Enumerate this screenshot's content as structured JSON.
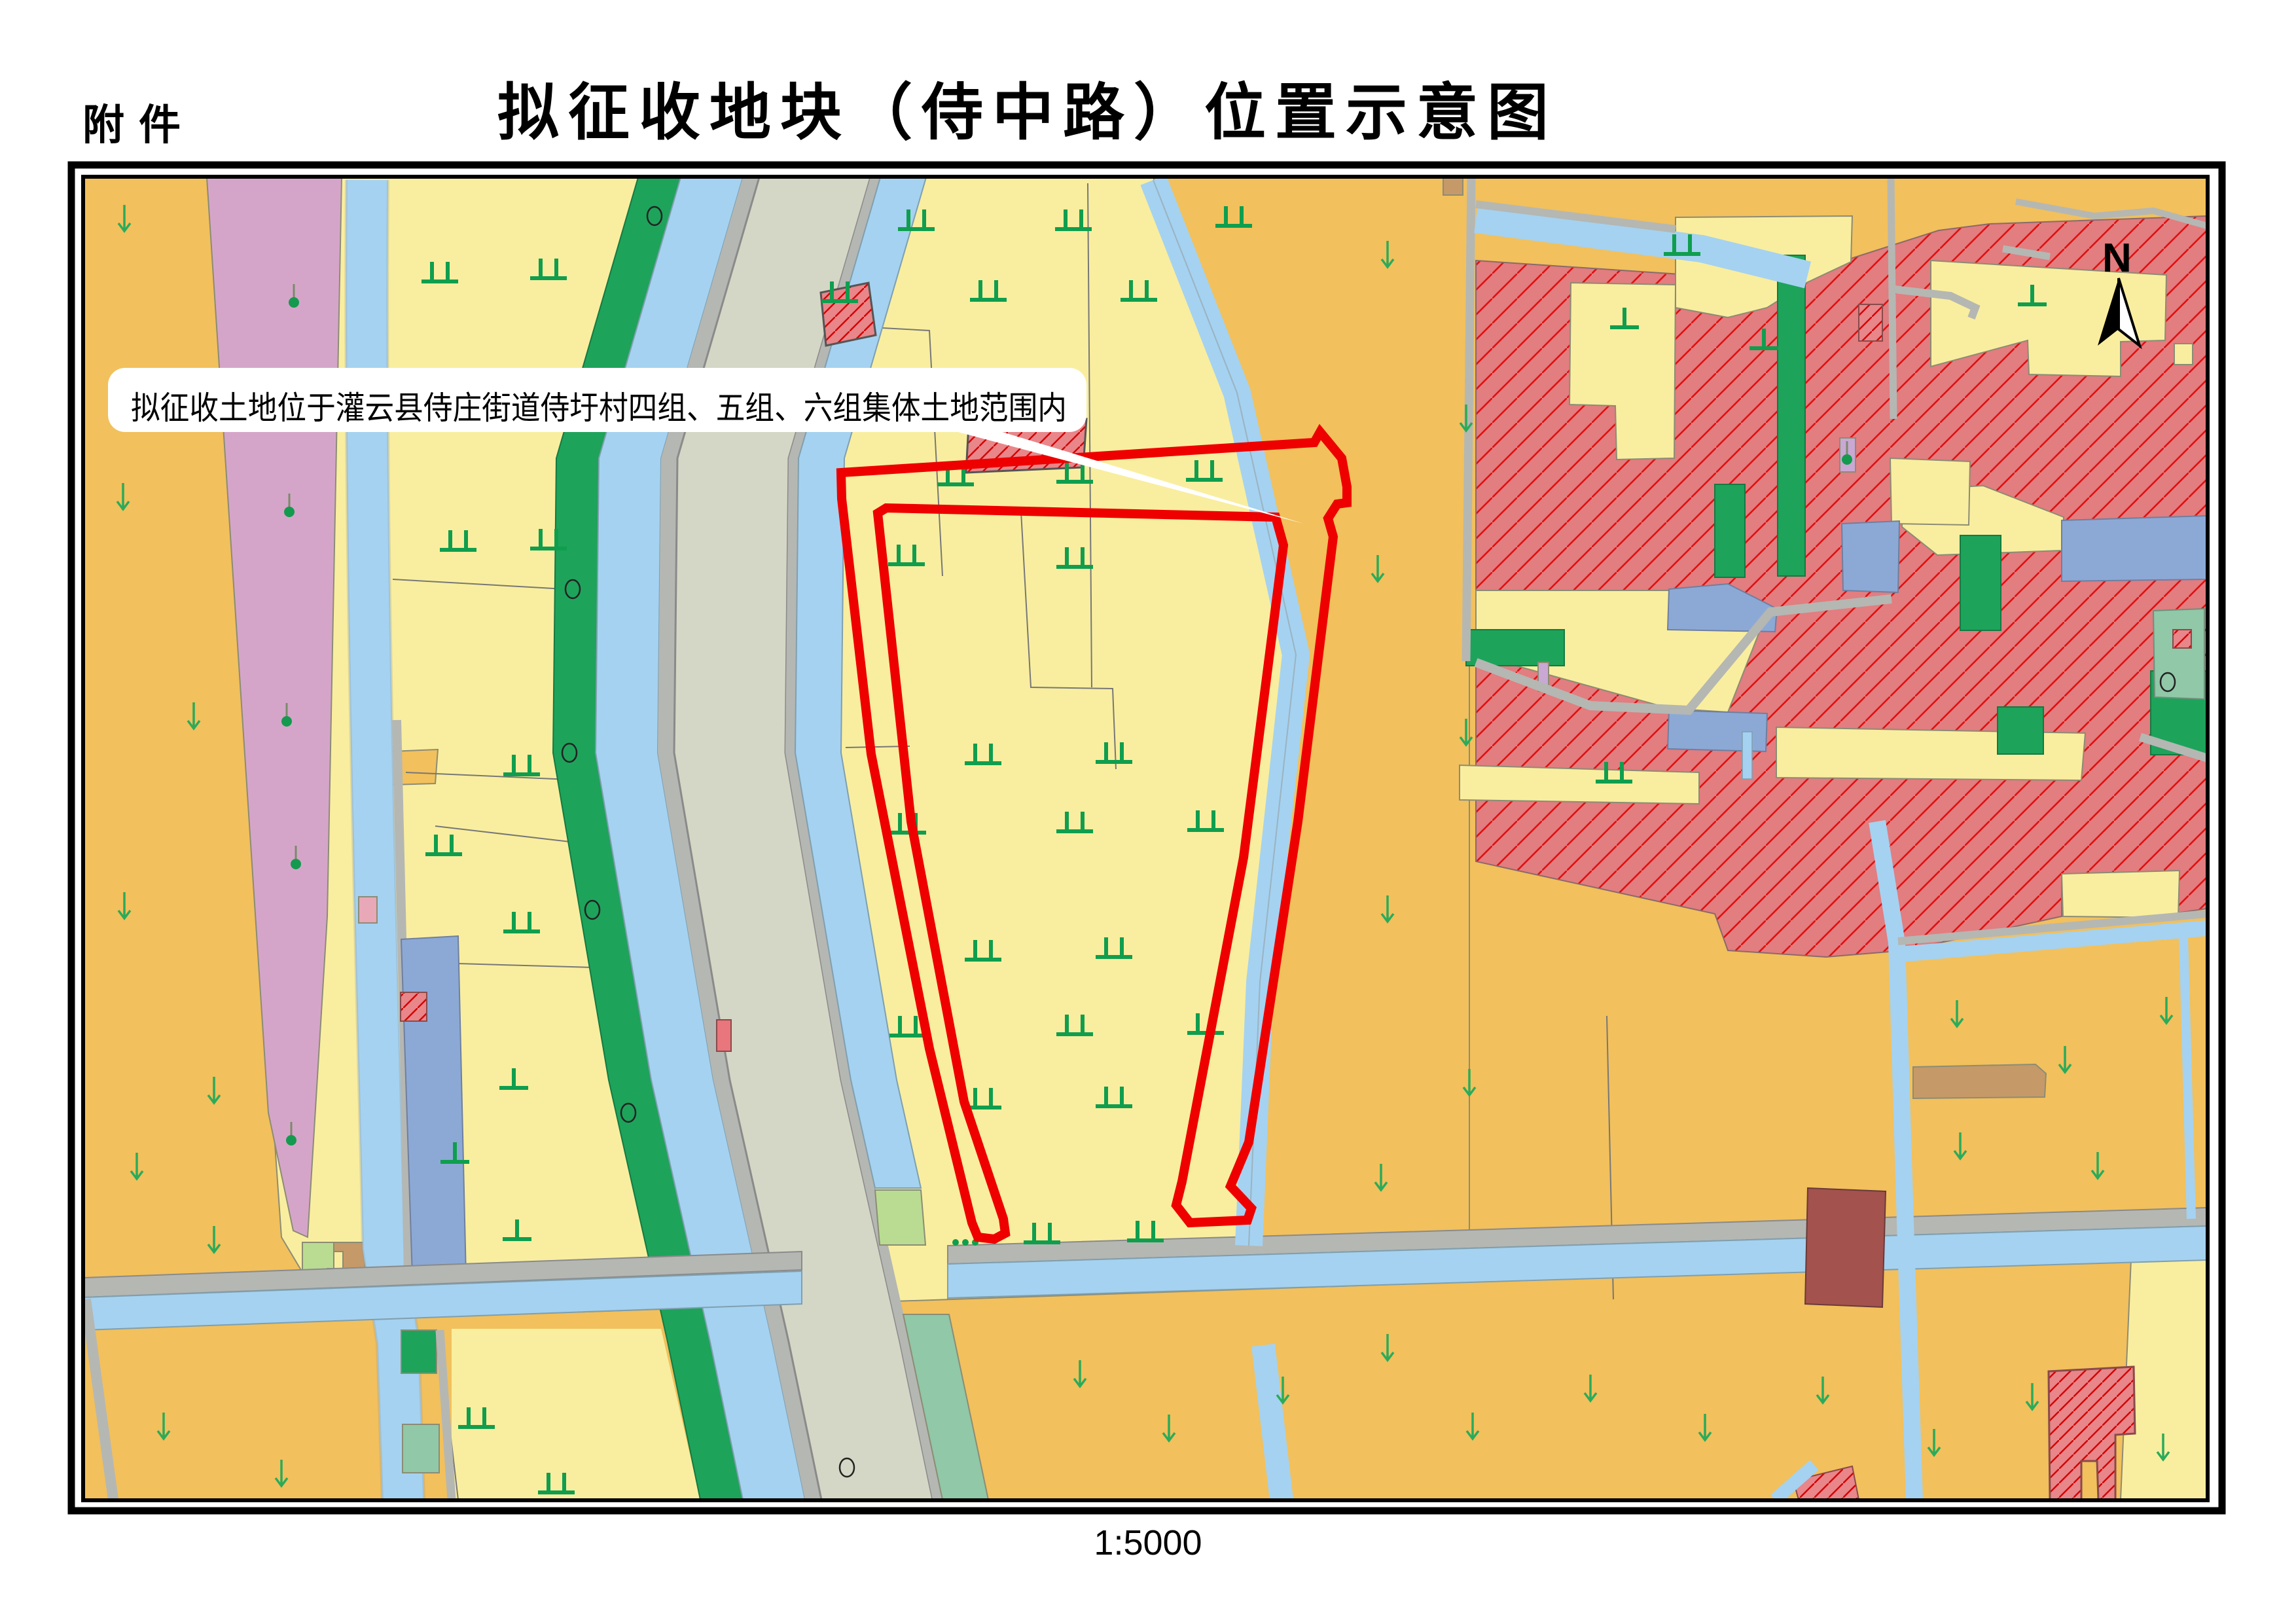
{
  "page": {
    "attachment_label": "附件",
    "title": "拟征收地块（侍中路）位置示意图",
    "scale_label": "1:5000"
  },
  "map": {
    "annotation_text": "拟征收土地位于灌云县侍庄街道侍圩村四组、五组、六组集体土地范围内",
    "north_label": "N",
    "markers": {
      "paddy-field-marker": "green double tick ⊥⊥",
      "dry-field-marker": "green single tick ⊥",
      "vegetable-field-marker": "green down arrow ↓",
      "tree-marker": "green dot with stem",
      "survey-circle-marker": "black ellipse outline",
      "north-arrow-icon": "half-filled compass arrow"
    },
    "colors": {
      "boundary_red": "#ee0000",
      "field_orange": "#f2c05c",
      "field_pale_yellow": "#f9ee9f",
      "orchard_pink": "#d5a5c9",
      "canal_blue": "#a5d2f0",
      "pond_steel_blue": "#8ca9d6",
      "forest_green": "#1ea35b",
      "light_green": "#b9dc92",
      "teal_green": "#90c8a8",
      "road_fill": "#d4d7c5",
      "minor_road_gray": "#b5b7b3",
      "urban_red": "#e27d80",
      "hatch_red": "#e01010",
      "symbol_green": "#0f9e4e"
    }
  }
}
